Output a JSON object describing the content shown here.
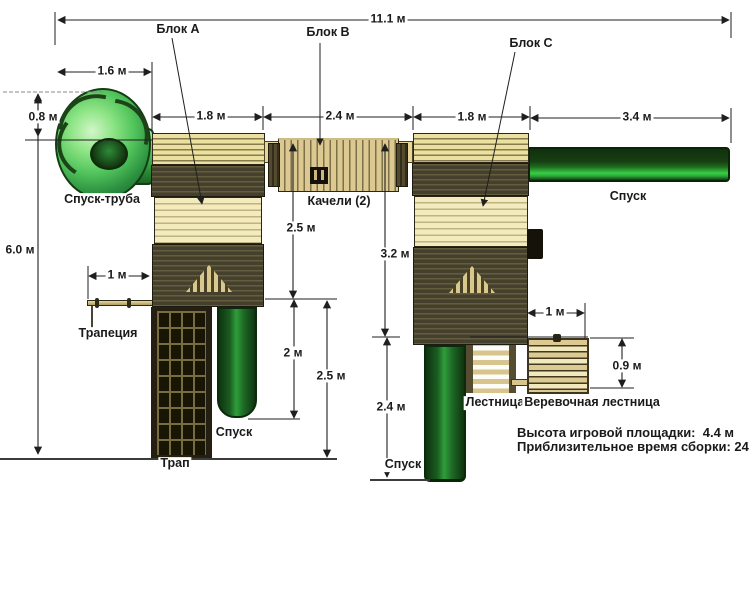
{
  "blocks": {
    "a": "Блок A",
    "b": "Блок B",
    "c": "Блок C"
  },
  "dimensions": {
    "total_width": "11.1 м",
    "spiral_width": "1.6 м",
    "spiral_height": "0.8 м",
    "block_a_width": "1.8 м",
    "block_b_width": "2.4 м",
    "block_c_width": "1.8 м",
    "slide_length": "3.4 м",
    "total_height": "6.0 м",
    "swing_beam_height": "2.5 м",
    "block_c_height": "3.2 м",
    "trapeze_offset": "1 м",
    "slide_drop": "2 м",
    "platform_height": "2.5 м",
    "tube_c_drop": "2.4 м",
    "ladder_offset": "1 м",
    "rope_ladder_height": "0.9 м"
  },
  "parts": {
    "spiral_slide": "Спуск-труба",
    "swings": "Качели (2)",
    "trapeze": "Трапеция",
    "cargo_net": "Трап",
    "slide_lower": "Спуск",
    "slide_main": "Спуск",
    "slide_rear": "Спуск",
    "ladder": "Лестница",
    "rope_ladder": "Веревочная лестница"
  },
  "notes": {
    "playground_height": "Высота игровой площадки:  4.4 м",
    "assembly_time": "Приблизительное время сборки: 24 часа"
  },
  "colors": {
    "wood_light": "#ece09e",
    "wood_pale": "#f3eabd",
    "wood_dark": "#45402c",
    "slide_green": "#2fae3c",
    "tube_green_dark": "#1b5c20",
    "line": "#1f1f1f"
  }
}
